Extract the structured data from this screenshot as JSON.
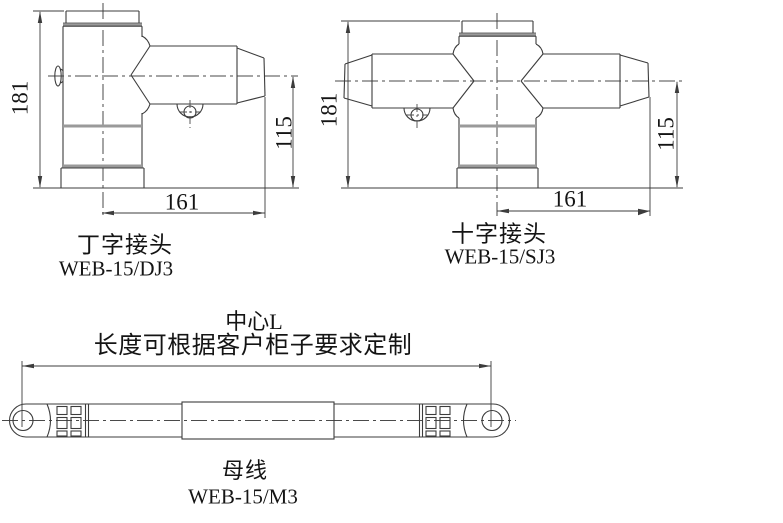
{
  "page": {
    "background": "#ffffff",
    "line_color": "#3c3c3c",
    "band_color": "#9a9a9a"
  },
  "figures": {
    "t_joint": {
      "title": "丁字接头",
      "model": "WEB-15/DJ3",
      "dim_height": "181",
      "dim_arm_height": "115",
      "dim_width": "161"
    },
    "cross_joint": {
      "title": "十字接头",
      "model": "WEB-15/SJ3",
      "dim_height": "181",
      "dim_arm_height": "115",
      "dim_width": "161"
    },
    "busbar": {
      "title": "母线",
      "model": "WEB-15/M3",
      "dim_center": "中心L",
      "dim_note": "长度可根据客户柜子要求定制"
    }
  }
}
